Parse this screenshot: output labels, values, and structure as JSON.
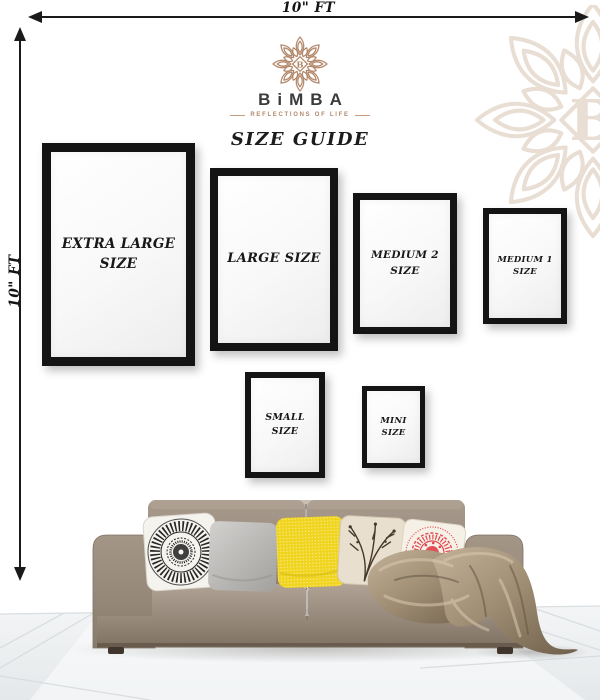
{
  "measurements": {
    "top_width_label": "10\" FT",
    "left_height_label": "10\" FT"
  },
  "brand": {
    "monogram": "B",
    "name": "BiMBA",
    "tagline": "REFLECTIONS OF LIFE",
    "watermark_monogram": "B"
  },
  "page_title": "SIZE GUIDE",
  "frames": [
    {
      "id": "extra-large",
      "line1": "EXTRA LARGE",
      "line2": "SIZE"
    },
    {
      "id": "large",
      "line1": "LARGE SIZE",
      "line2": ""
    },
    {
      "id": "medium-2",
      "line1": "MEDIUM 2",
      "line2": "SIZE"
    },
    {
      "id": "medium-1",
      "line1": "MEDIUM 1",
      "line2": "SIZE"
    },
    {
      "id": "small",
      "line1": "SMALL",
      "line2": "SIZE"
    },
    {
      "id": "mini",
      "line1": "MINI",
      "line2": "SIZE"
    }
  ],
  "colors": {
    "accent_tan": "#b3886a",
    "watermark_beige": "#e9ded3",
    "frame_black": "#141414",
    "sofa_taupe": "#9a8c7e",
    "pillow_yellow": "#f0d41d",
    "pillow_red": "#e2464e",
    "throw_bronze": "#a8967c",
    "text_dark": "#1c1c1c"
  }
}
